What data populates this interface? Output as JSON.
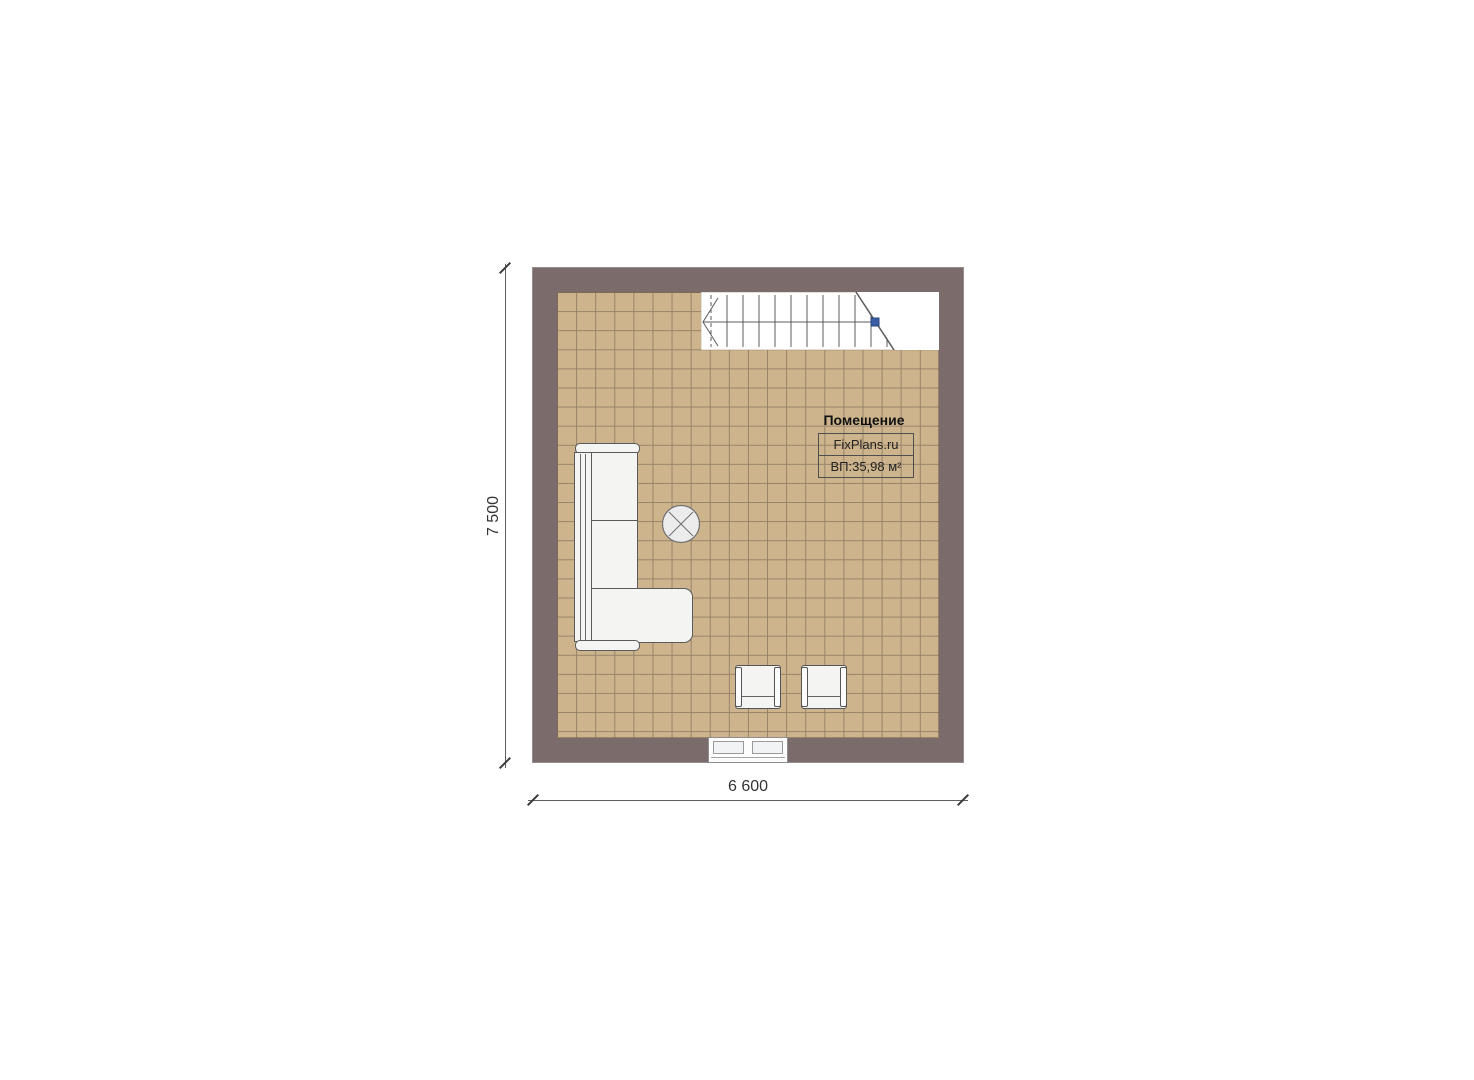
{
  "plan": {
    "room_title": "Помещение",
    "brand": "FixPlans.ru",
    "area": "ВП:35,98 м²"
  },
  "dimensions": {
    "height_label": "7 500",
    "width_label": "6 600"
  },
  "colors": {
    "wall": "#7B6B6B",
    "floor": "#CDB48C",
    "floor_grid": "#97836A",
    "stair_marker": "#3A5FA8",
    "furniture_fill": "#F4F4F3"
  }
}
